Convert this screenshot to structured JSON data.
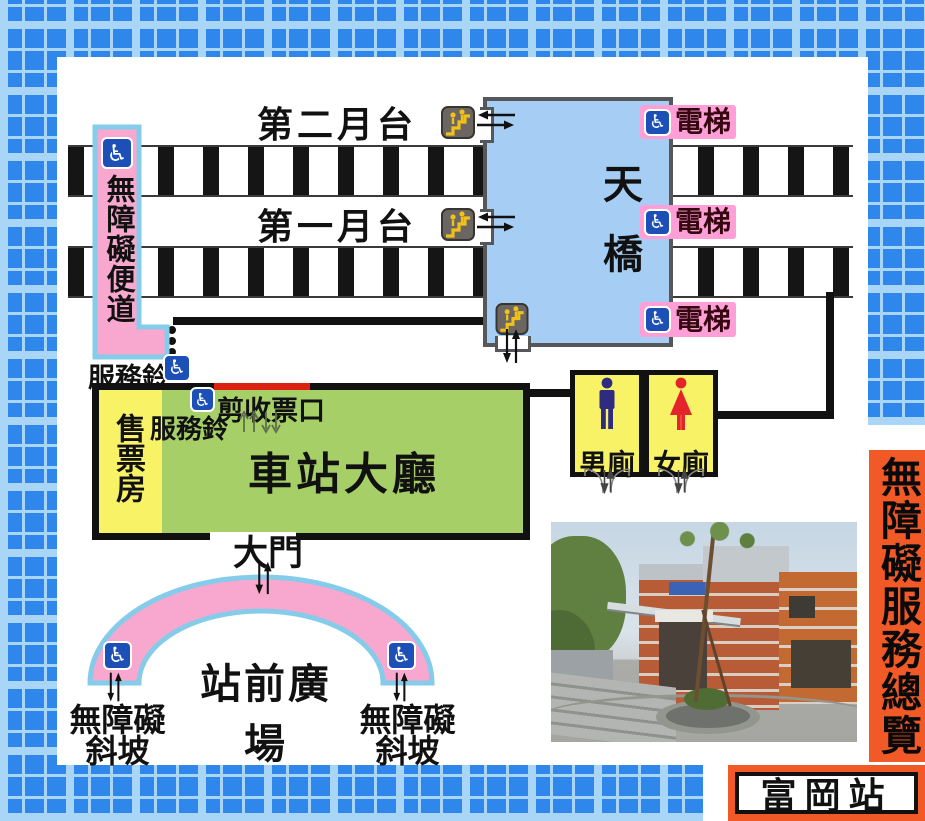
{
  "banner": {
    "title": "無障礙服務總覽",
    "station": "富岡站"
  },
  "platforms": {
    "platform2_label": "第二月台",
    "platform1_label": "第一月台"
  },
  "footbridge": {
    "label": "天橋",
    "elevators": [
      {
        "label": "電梯"
      },
      {
        "label": "電梯"
      },
      {
        "label": "電梯"
      }
    ]
  },
  "accessible_path": {
    "label": "無障礙便道",
    "service_bell_label": "服務鈴"
  },
  "hall": {
    "ticket_office_label": "售票房",
    "hall_label": "車站大廳",
    "gate_label": "剪收票口",
    "service_bell_label": "服務鈴",
    "main_gate_label": "大門"
  },
  "toilets": {
    "men_label": "男廁",
    "women_label": "女廁"
  },
  "plaza": {
    "label": "站前廣場",
    "ramps": [
      {
        "line1": "無障礙",
        "line2": "斜坡"
      },
      {
        "line1": "無障礙",
        "line2": "斜坡"
      }
    ]
  },
  "colors": {
    "tile_blue": "#2F87EB",
    "tile_light_blue": "#A9D6F7",
    "footbridge_blue": "#A6CDF3",
    "outline_gray": "#56575B",
    "path_pink": "#F8A8CE",
    "path_border_blue": "#85CBEA",
    "hall_green": "#A7CF68",
    "ticket_yellow": "#F7F266",
    "gate_red": "#DE2212",
    "elevator_pink": "#FF9FD8",
    "wheelchair_blue": "#1C50B6",
    "man_navy": "#2F2B7E",
    "woman_red": "#E3242B",
    "stairs_yellow": "#F0C11B",
    "banner_orange": "#F15A27"
  }
}
